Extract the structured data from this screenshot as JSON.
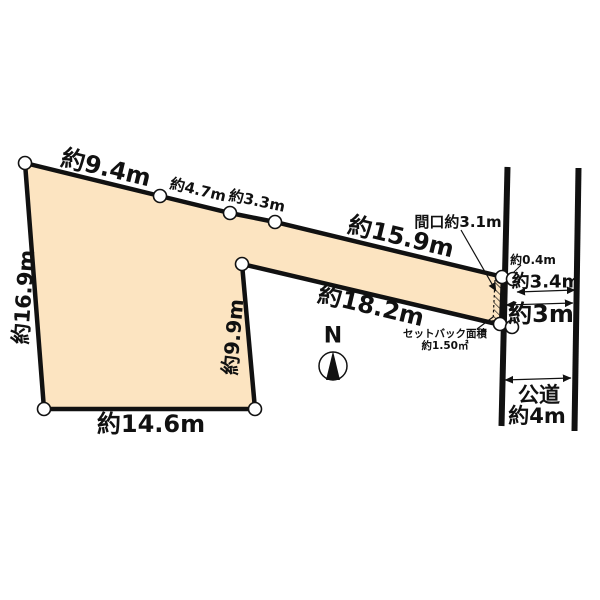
{
  "plot": {
    "fill_color": "#FCE4C1",
    "outline_color": "#111111",
    "edge_labels": {
      "top_left_segment": "約9.4m",
      "top_mid_segment": "約4.7m",
      "top_right_segment": "約3.3m",
      "strip_top": "約15.9m",
      "strip_bottom": "約18.2m",
      "west_side": "約16.9m",
      "inner_side": "約9.9m",
      "south_side": "約14.6m"
    },
    "frontage_label": "間口約3.1m",
    "offset_label": "約0.4m",
    "across_road_label": "約3.4m",
    "road_gap_label": "約3m",
    "setback_area_line1": "セットバック面積",
    "setback_area_line2": "約1.50㎡"
  },
  "road": {
    "name": "公道",
    "width_label": "約4m"
  },
  "compass": {
    "north_label": "N"
  }
}
